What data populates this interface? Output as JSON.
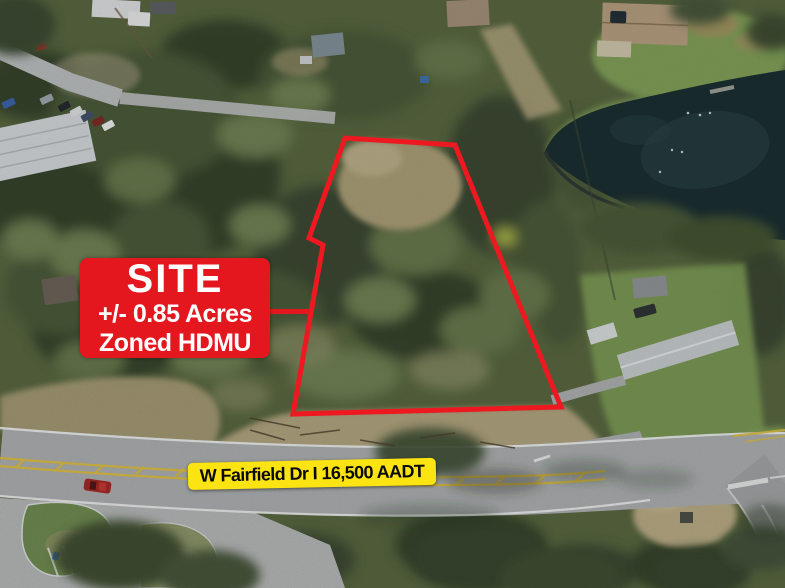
{
  "photo": {
    "description": "Aerial drone photo of a wooded vacant land parcel beside a pond, bordered by W Fairfield Dr",
    "width_px": 785,
    "height_px": 588
  },
  "annotations": {
    "site_box": {
      "title": "SITE",
      "area": "+/- 0.85 Acres",
      "zoning": "Zoned HDMU",
      "bg_color": "#e4171f",
      "text_color": "#ffffff"
    },
    "boundary": {
      "color": "#ee1820",
      "stroke_px": 5
    },
    "leader_line_color": "#e4171f",
    "road_banner": {
      "text": "W Fairfield Dr I 16,500 AADT",
      "bg_color": "#fce413",
      "text_color": "#0a0a0a"
    }
  }
}
